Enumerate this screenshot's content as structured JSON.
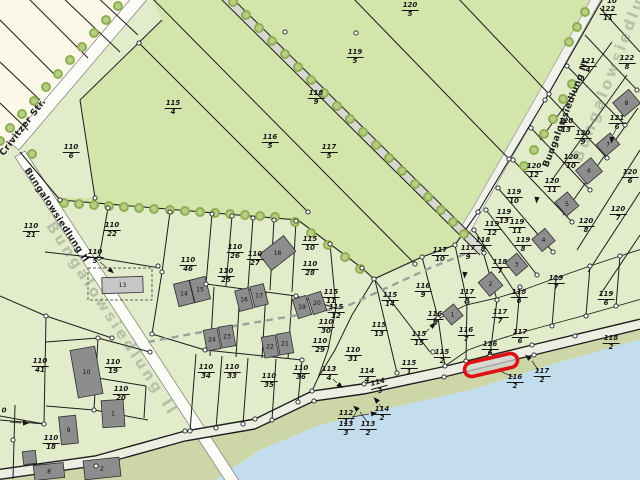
{
  "map": {
    "title": "cadastral-parcel-map",
    "streets": [
      {
        "name": "Crivitzer Str.",
        "x": 2,
        "y": 150,
        "rot": -52
      },
      {
        "name": "Bungalowsiedlung II",
        "x": 26,
        "y": 164,
        "rot": 57
      },
      {
        "name": "Bungalowsiedlung III",
        "x": 546,
        "y": 162,
        "rot": -69
      }
    ],
    "watermarks": [
      {
        "text": "Bungalowsiedlung II",
        "x": 50,
        "y": 214,
        "rot": 57
      },
      {
        "text": "Bungalowsiedlung",
        "x": 577,
        "y": 152,
        "rot": -69
      }
    ],
    "colors": {
      "field_green": "#d3e5ab",
      "area_green": "#e2ecca",
      "cream": "#fbf8ea",
      "water": "#c3dded",
      "beach": "#ccd6a6",
      "road_white": "#fdfdf8",
      "path_gray": "#d8d8d0",
      "building_dark": "#8d8d8d",
      "building_light": "#c6c6c6",
      "line": "#1c1c1c",
      "highlight": "#dd1114",
      "tree_fill": "#b8cf83",
      "tree_ring": "#8fae54"
    },
    "highlight": {
      "x": 464,
      "y": 358,
      "w": 54,
      "h": 14,
      "rot": -13,
      "cx": 491,
      "cy": 365
    },
    "parcels": [
      {
        "n": "110",
        "d": "6",
        "x": 71,
        "y": 152
      },
      {
        "n": "115",
        "d": "4",
        "x": 173,
        "y": 108
      },
      {
        "n": "116",
        "d": "5",
        "x": 270,
        "y": 142
      },
      {
        "n": "117",
        "d": "5",
        "x": 329,
        "y": 152
      },
      {
        "n": "118",
        "d": "9",
        "x": 316,
        "y": 98
      },
      {
        "n": "119",
        "d": "5",
        "x": 355,
        "y": 57
      },
      {
        "n": "120",
        "d": "5",
        "x": 410,
        "y": 10
      },
      {
        "n": "122",
        "d": "10",
        "x": 612,
        "y": -3
      },
      {
        "n": "122",
        "d": "11",
        "x": 608,
        "y": 14
      },
      {
        "n": "122",
        "d": "8",
        "x": 627,
        "y": 63
      },
      {
        "n": "121",
        "d": "4",
        "x": 588,
        "y": 66
      },
      {
        "n": "121",
        "d": "6",
        "x": 617,
        "y": 123
      },
      {
        "n": "120",
        "d": "13",
        "x": 566,
        "y": 126
      },
      {
        "n": "120",
        "d": "9",
        "x": 583,
        "y": 138
      },
      {
        "n": "120",
        "d": "10",
        "x": 571,
        "y": 162
      },
      {
        "n": "120",
        "d": "12",
        "x": 534,
        "y": 171
      },
      {
        "n": "120",
        "d": "11",
        "x": 552,
        "y": 186
      },
      {
        "n": "119",
        "d": "10",
        "x": 514,
        "y": 197
      },
      {
        "n": "119",
        "d": "13",
        "x": 504,
        "y": 217
      },
      {
        "n": "119",
        "d": "12",
        "x": 492,
        "y": 229
      },
      {
        "n": "119",
        "d": "11",
        "x": 517,
        "y": 227
      },
      {
        "n": "119",
        "d": "8",
        "x": 523,
        "y": 245
      },
      {
        "n": "120",
        "d": "6",
        "x": 630,
        "y": 177
      },
      {
        "n": "120",
        "d": "7",
        "x": 618,
        "y": 214
      },
      {
        "n": "120",
        "d": "8",
        "x": 586,
        "y": 226
      },
      {
        "n": "117",
        "d": "10",
        "x": 440,
        "y": 255
      },
      {
        "n": "117",
        "d": "9",
        "x": 468,
        "y": 253
      },
      {
        "n": "118",
        "d": "8",
        "x": 483,
        "y": 245
      },
      {
        "n": "118",
        "d": "7",
        "x": 500,
        "y": 267
      },
      {
        "n": "117",
        "d": "8",
        "x": 467,
        "y": 297
      },
      {
        "n": "118",
        "d": "6",
        "x": 519,
        "y": 297
      },
      {
        "n": "117",
        "d": "7",
        "x": 500,
        "y": 317
      },
      {
        "n": "116",
        "d": "8",
        "x": 435,
        "y": 319
      },
      {
        "n": "116",
        "d": "7",
        "x": 466,
        "y": 335
      },
      {
        "n": "116",
        "d": "6",
        "x": 490,
        "y": 349
      },
      {
        "n": "117",
        "d": "6",
        "x": 520,
        "y": 337
      },
      {
        "n": "119",
        "d": "7",
        "x": 556,
        "y": 283
      },
      {
        "n": "119",
        "d": "6",
        "x": 606,
        "y": 299
      },
      {
        "n": "118",
        "d": "2",
        "x": 611,
        "y": 343
      },
      {
        "n": "115",
        "d": "2",
        "x": 442,
        "y": 357
      },
      {
        "n": "116",
        "d": "2",
        "x": 515,
        "y": 382
      },
      {
        "n": "117",
        "d": "2",
        "x": 542,
        "y": 376
      },
      {
        "n": "110",
        "d": "21",
        "x": 31,
        "y": 231
      },
      {
        "n": "110",
        "d": "22",
        "x": 112,
        "y": 230
      },
      {
        "n": "110",
        "d": "5",
        "x": 95,
        "y": 257
      },
      {
        "n": "110",
        "d": "46",
        "x": 188,
        "y": 265
      },
      {
        "n": "110",
        "d": "26",
        "x": 235,
        "y": 252
      },
      {
        "n": "110",
        "d": "27",
        "x": 255,
        "y": 259
      },
      {
        "n": "110",
        "d": "25",
        "x": 226,
        "y": 276
      },
      {
        "n": "115",
        "d": "10",
        "x": 310,
        "y": 244
      },
      {
        "n": "110",
        "d": "28",
        "x": 310,
        "y": 269
      },
      {
        "n": "115",
        "d": "11",
        "x": 331,
        "y": 297
      },
      {
        "n": "115",
        "d": "12",
        "x": 336,
        "y": 312
      },
      {
        "n": "110",
        "d": "30",
        "x": 326,
        "y": 327
      },
      {
        "n": "110",
        "d": "29",
        "x": 320,
        "y": 346
      },
      {
        "n": "110",
        "d": "31",
        "x": 353,
        "y": 355
      },
      {
        "n": "110",
        "d": "36",
        "x": 301,
        "y": 373
      },
      {
        "n": "113",
        "d": "4",
        "x": 329,
        "y": 374
      },
      {
        "n": "114",
        "d": "4",
        "x": 367,
        "y": 376
      },
      {
        "n": "114",
        "d": "3",
        "x": 379,
        "y": 387,
        "rot": -15
      },
      {
        "n": "115",
        "d": "1",
        "x": 409,
        "y": 368
      },
      {
        "n": "115",
        "d": "15",
        "x": 419,
        "y": 339
      },
      {
        "n": "115",
        "d": "13",
        "x": 379,
        "y": 330
      },
      {
        "n": "115",
        "d": "14",
        "x": 390,
        "y": 300
      },
      {
        "n": "116",
        "d": "9",
        "x": 423,
        "y": 291
      },
      {
        "n": "112",
        "d": "1",
        "x": 346,
        "y": 418
      },
      {
        "n": "113",
        "d": "3",
        "x": 346,
        "y": 429
      },
      {
        "n": "113",
        "d": "2",
        "x": 368,
        "y": 429
      },
      {
        "n": "114",
        "d": "2",
        "x": 382,
        "y": 414
      },
      {
        "n": "110",
        "d": "34",
        "x": 206,
        "y": 372
      },
      {
        "n": "110",
        "d": "33",
        "x": 232,
        "y": 372
      },
      {
        "n": "110",
        "d": "35",
        "x": 269,
        "y": 381
      },
      {
        "n": "110",
        "d": "41",
        "x": 40,
        "y": 366
      },
      {
        "n": "110",
        "d": "19",
        "x": 113,
        "y": 367
      },
      {
        "n": "110",
        "d": "20",
        "x": 121,
        "y": 394
      },
      {
        "n": "110",
        "d": "18",
        "x": 51,
        "y": 443
      },
      {
        "n": "0",
        "d": "",
        "x": 4,
        "y": 411
      }
    ],
    "buildings": [
      {
        "n": "13",
        "x": 102,
        "y": 277,
        "w": 41,
        "h": 16,
        "rot": -2,
        "tone": "light"
      },
      {
        "n": "14",
        "x": 176,
        "y": 282,
        "w": 16,
        "h": 23,
        "rot": -14
      },
      {
        "n": "15",
        "x": 192,
        "y": 278,
        "w": 16,
        "h": 23,
        "rot": -14
      },
      {
        "n": "16",
        "x": 237,
        "y": 289,
        "w": 14,
        "h": 21,
        "rot": -14
      },
      {
        "n": "17",
        "x": 252,
        "y": 285,
        "w": 14,
        "h": 21,
        "rot": -14
      },
      {
        "n": "18",
        "x": 262,
        "y": 243,
        "w": 31,
        "h": 20,
        "rot": -38
      },
      {
        "n": "19",
        "x": 295,
        "y": 297,
        "w": 14,
        "h": 20,
        "rot": -18
      },
      {
        "n": "20",
        "x": 310,
        "y": 293,
        "w": 14,
        "h": 20,
        "rot": -18
      },
      {
        "n": "24",
        "x": 205,
        "y": 329,
        "w": 14,
        "h": 21,
        "rot": -10
      },
      {
        "n": "23",
        "x": 220,
        "y": 326,
        "w": 14,
        "h": 21,
        "rot": -10
      },
      {
        "n": "22",
        "x": 263,
        "y": 336,
        "w": 14,
        "h": 21,
        "rot": -10
      },
      {
        "n": "21",
        "x": 278,
        "y": 333,
        "w": 14,
        "h": 21,
        "rot": -10
      },
      {
        "n": "8",
        "x": 616,
        "y": 94,
        "w": 21,
        "h": 18,
        "rot": -40
      },
      {
        "n": "7",
        "x": 599,
        "y": 137,
        "w": 18,
        "h": 15,
        "rot": -40
      },
      {
        "n": "6",
        "x": 579,
        "y": 162,
        "w": 20,
        "h": 18,
        "rot": -40
      },
      {
        "n": "5",
        "x": 559,
        "y": 195,
        "w": 16,
        "h": 18,
        "rot": -40
      },
      {
        "n": "4",
        "x": 535,
        "y": 232,
        "w": 17,
        "h": 16,
        "rot": -40
      },
      {
        "n": "3",
        "x": 509,
        "y": 256,
        "w": 15,
        "h": 17,
        "rot": -40
      },
      {
        "n": "2",
        "x": 482,
        "y": 275,
        "w": 17,
        "h": 18,
        "rot": -40
      },
      {
        "n": "1",
        "x": 445,
        "y": 307,
        "w": 15,
        "h": 15,
        "rot": -40
      },
      {
        "n": "10",
        "x": 74,
        "y": 348,
        "w": 25,
        "h": 48,
        "rot": -10
      },
      {
        "n": "9",
        "x": 60,
        "y": 416,
        "w": 17,
        "h": 28,
        "rot": -6
      },
      {
        "n": "1",
        "x": 102,
        "y": 400,
        "w": 22,
        "h": 27,
        "rot": -4
      },
      {
        "n": "2",
        "x": 84,
        "y": 459,
        "w": 36,
        "h": 19,
        "rot": -6
      },
      {
        "n": "8",
        "x": 34,
        "y": 464,
        "w": 30,
        "h": 15,
        "rot": -6
      },
      {
        "n": "",
        "x": 23,
        "y": 451,
        "w": 13,
        "h": 13,
        "rot": -6
      }
    ]
  }
}
